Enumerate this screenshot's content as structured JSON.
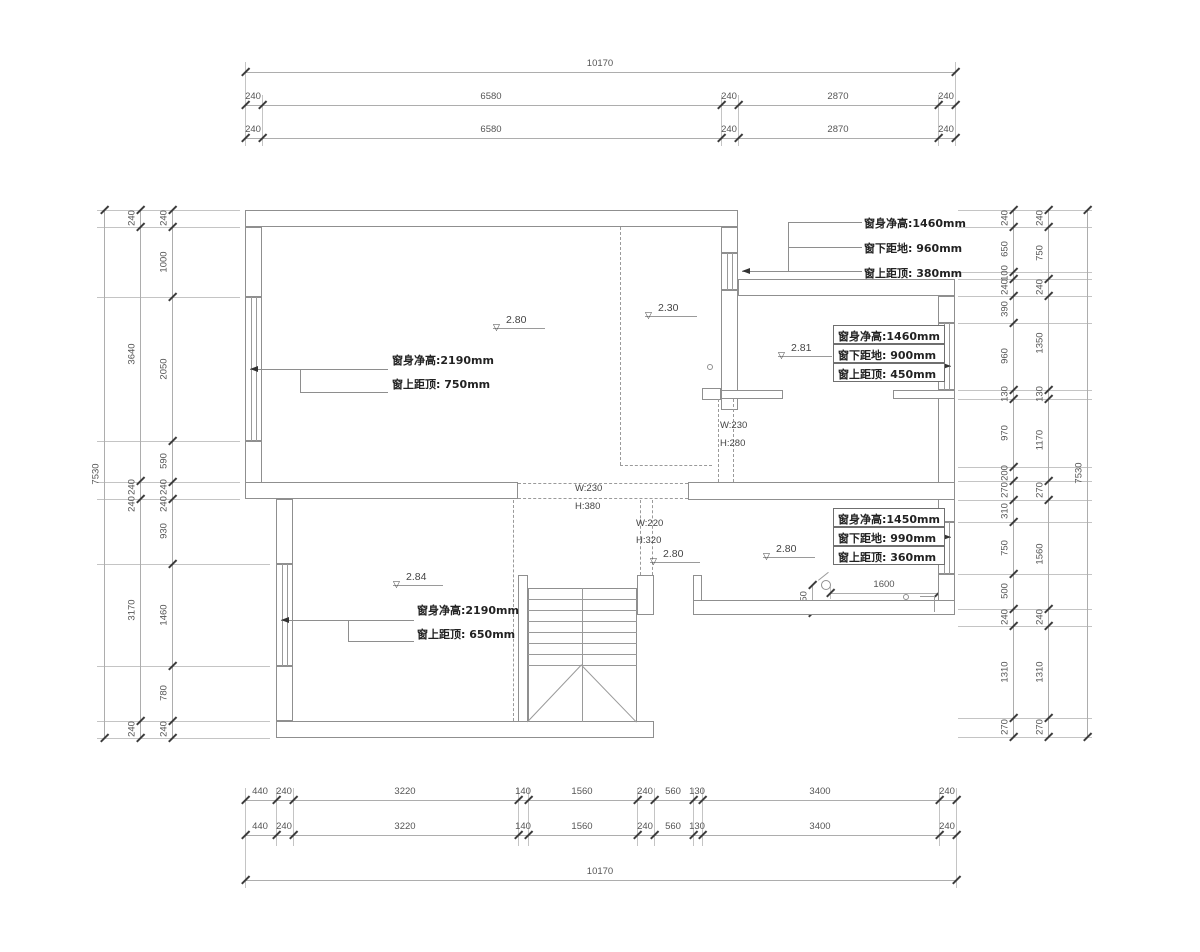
{
  "drawing_type": "floor-plan",
  "colors": {
    "wall": "#8f8f8f",
    "dim_text": "#555555",
    "tick": "#3c3c3c",
    "annotation": "#222222",
    "leader": "#8e8e8e"
  },
  "chains": [
    {
      "id": "top-total",
      "dir": "h",
      "pos": 72,
      "from": 245,
      "to": 955,
      "ticks": [
        245,
        955
      ],
      "labels": [
        {
          "t": "10170",
          "p": 600
        }
      ]
    },
    {
      "id": "top-row1",
      "dir": "h",
      "pos": 105,
      "from": 245,
      "to": 955,
      "ticks": [
        245,
        262,
        721,
        738,
        938,
        955
      ],
      "labels": [
        {
          "t": "240",
          "p": 253
        },
        {
          "t": "6580",
          "p": 491
        },
        {
          "t": "240",
          "p": 729
        },
        {
          "t": "2870",
          "p": 838
        },
        {
          "t": "240",
          "p": 946
        }
      ]
    },
    {
      "id": "top-row2",
      "dir": "h",
      "pos": 138,
      "from": 245,
      "to": 955,
      "ticks": [
        245,
        262,
        721,
        738,
        938,
        955
      ],
      "labels": [
        {
          "t": "240",
          "p": 253
        },
        {
          "t": "6580",
          "p": 491
        },
        {
          "t": "240",
          "p": 729
        },
        {
          "t": "2870",
          "p": 838
        },
        {
          "t": "240",
          "p": 946
        }
      ]
    },
    {
      "id": "bottom-row1",
      "dir": "h",
      "pos": 800,
      "from": 245,
      "to": 956,
      "ticks": [
        245,
        276,
        293,
        518,
        528,
        637,
        654,
        693,
        702,
        939,
        956
      ],
      "labels": [
        {
          "t": "440",
          "p": 260
        },
        {
          "t": "240",
          "p": 284
        },
        {
          "t": "3220",
          "p": 405
        },
        {
          "t": "140",
          "p": 523
        },
        {
          "t": "1560",
          "p": 582
        },
        {
          "t": "240",
          "p": 645
        },
        {
          "t": "560",
          "p": 673
        },
        {
          "t": "130",
          "p": 697
        },
        {
          "t": "3400",
          "p": 820
        },
        {
          "t": "240",
          "p": 947
        }
      ]
    },
    {
      "id": "bottom-row2",
      "dir": "h",
      "pos": 835,
      "from": 245,
      "to": 956,
      "ticks": [
        245,
        276,
        293,
        518,
        528,
        637,
        654,
        693,
        702,
        939,
        956
      ],
      "labels": [
        {
          "t": "440",
          "p": 260
        },
        {
          "t": "240",
          "p": 284
        },
        {
          "t": "3220",
          "p": 405
        },
        {
          "t": "140",
          "p": 523
        },
        {
          "t": "1560",
          "p": 582
        },
        {
          "t": "240",
          "p": 645
        },
        {
          "t": "560",
          "p": 673
        },
        {
          "t": "130",
          "p": 697
        },
        {
          "t": "3400",
          "p": 820
        },
        {
          "t": "240",
          "p": 947
        }
      ]
    },
    {
      "id": "bottom-total",
      "dir": "h",
      "pos": 880,
      "from": 245,
      "to": 956,
      "ticks": [
        245,
        956
      ],
      "labels": [
        {
          "t": "10170",
          "p": 600
        }
      ]
    },
    {
      "id": "left-outer",
      "dir": "v",
      "pos": 104,
      "from": 210,
      "to": 738,
      "ticks": [
        210,
        738
      ],
      "labels": [
        {
          "t": "7530",
          "p": 474
        }
      ]
    },
    {
      "id": "left-mid",
      "dir": "v",
      "pos": 140,
      "from": 210,
      "to": 738,
      "ticks": [
        210,
        227,
        481,
        499,
        721,
        738
      ],
      "labels": [
        {
          "t": "240",
          "p": 218
        },
        {
          "t": "3640",
          "p": 354
        },
        {
          "t": "240",
          "p": 487
        },
        {
          "t": "240",
          "p": 504
        },
        {
          "t": "3170",
          "p": 610
        },
        {
          "t": "240",
          "p": 729
        }
      ]
    },
    {
      "id": "left-inner",
      "dir": "v",
      "pos": 172,
      "from": 210,
      "to": 738,
      "ticks": [
        210,
        227,
        297,
        441,
        482,
        499,
        564,
        666,
        721,
        738
      ],
      "labels": [
        {
          "t": "240",
          "p": 218
        },
        {
          "t": "1000",
          "p": 262
        },
        {
          "t": "2050",
          "p": 369
        },
        {
          "t": "590",
          "p": 461
        },
        {
          "t": "240",
          "p": 487
        },
        {
          "t": "240",
          "p": 504
        },
        {
          "t": "930",
          "p": 531
        },
        {
          "t": "1460",
          "p": 615
        },
        {
          "t": "780",
          "p": 693
        },
        {
          "t": "240",
          "p": 729
        }
      ]
    },
    {
      "id": "right-inner",
      "dir": "v",
      "pos": 1013,
      "from": 210,
      "to": 737,
      "ticks": [
        210,
        227,
        272,
        279,
        296,
        323,
        390,
        399,
        467,
        481,
        500,
        522,
        574,
        609,
        626,
        718,
        737
      ],
      "labels": [
        {
          "t": "240",
          "p": 218
        },
        {
          "t": "650",
          "p": 249
        },
        {
          "t": "100",
          "p": 273
        },
        {
          "t": "240",
          "p": 287
        },
        {
          "t": "390",
          "p": 309
        },
        {
          "t": "960",
          "p": 356
        },
        {
          "t": "130",
          "p": 394
        },
        {
          "t": "970",
          "p": 433
        },
        {
          "t": "200",
          "p": 473
        },
        {
          "t": "270",
          "p": 490
        },
        {
          "t": "310",
          "p": 511
        },
        {
          "t": "750",
          "p": 548
        },
        {
          "t": "500",
          "p": 591
        },
        {
          "t": "240",
          "p": 617
        },
        {
          "t": "1310",
          "p": 672
        },
        {
          "t": "270",
          "p": 727
        }
      ]
    },
    {
      "id": "right-mid",
      "dir": "v",
      "pos": 1048,
      "from": 210,
      "to": 737,
      "ticks": [
        210,
        227,
        279,
        296,
        390,
        399,
        481,
        500,
        609,
        626,
        718,
        737
      ],
      "labels": [
        {
          "t": "240",
          "p": 218
        },
        {
          "t": "750",
          "p": 253
        },
        {
          "t": "240",
          "p": 287
        },
        {
          "t": "1350",
          "p": 343
        },
        {
          "t": "130",
          "p": 394
        },
        {
          "t": "1170",
          "p": 440
        },
        {
          "t": "270",
          "p": 490
        },
        {
          "t": "1560",
          "p": 554
        },
        {
          "t": "240",
          "p": 617
        },
        {
          "t": "1310",
          "p": 672
        },
        {
          "t": "270",
          "p": 727
        }
      ]
    },
    {
      "id": "right-outer",
      "dir": "v",
      "pos": 1087,
      "from": 210,
      "to": 737,
      "ticks": [
        210,
        737
      ],
      "labels": [
        {
          "t": "7530",
          "p": 473
        }
      ]
    },
    {
      "id": "dim-1600",
      "dir": "h",
      "pos": 593,
      "from": 830,
      "to": 938,
      "ticks": [
        830,
        938
      ],
      "labels": [
        {
          "t": "1600",
          "p": 884
        }
      ]
    },
    {
      "id": "dim-350",
      "dir": "v",
      "pos": 812,
      "from": 585,
      "to": 613,
      "ticks": [
        585,
        613
      ],
      "labels": [
        {
          "t": "350",
          "p": 599
        }
      ]
    }
  ],
  "ext_lines": [
    {
      "x1": 245,
      "y1": 62,
      "x2": 245,
      "y2": 146
    },
    {
      "x1": 955,
      "y1": 62,
      "x2": 955,
      "y2": 146
    },
    {
      "x1": 262,
      "y1": 95,
      "x2": 262,
      "y2": 146
    },
    {
      "x1": 721,
      "y1": 95,
      "x2": 721,
      "y2": 146
    },
    {
      "x1": 738,
      "y1": 95,
      "x2": 738,
      "y2": 146
    },
    {
      "x1": 938,
      "y1": 95,
      "x2": 938,
      "y2": 146
    },
    {
      "x1": 245,
      "y1": 788,
      "x2": 245,
      "y2": 888
    },
    {
      "x1": 956,
      "y1": 788,
      "x2": 956,
      "y2": 888
    },
    {
      "x1": 276,
      "y1": 788,
      "x2": 276,
      "y2": 846
    },
    {
      "x1": 293,
      "y1": 788,
      "x2": 293,
      "y2": 846
    },
    {
      "x1": 518,
      "y1": 788,
      "x2": 518,
      "y2": 846
    },
    {
      "x1": 528,
      "y1": 788,
      "x2": 528,
      "y2": 846
    },
    {
      "x1": 637,
      "y1": 788,
      "x2": 637,
      "y2": 846
    },
    {
      "x1": 654,
      "y1": 788,
      "x2": 654,
      "y2": 846
    },
    {
      "x1": 693,
      "y1": 788,
      "x2": 693,
      "y2": 846
    },
    {
      "x1": 702,
      "y1": 788,
      "x2": 702,
      "y2": 846
    },
    {
      "x1": 939,
      "y1": 788,
      "x2": 939,
      "y2": 846
    },
    {
      "x1": 97,
      "y1": 210,
      "x2": 240,
      "y2": 210
    },
    {
      "x1": 97,
      "y1": 227,
      "x2": 240,
      "y2": 227
    },
    {
      "x1": 97,
      "y1": 297,
      "x2": 240,
      "y2": 297
    },
    {
      "x1": 97,
      "y1": 441,
      "x2": 240,
      "y2": 441
    },
    {
      "x1": 97,
      "y1": 482,
      "x2": 240,
      "y2": 482
    },
    {
      "x1": 97,
      "y1": 499,
      "x2": 240,
      "y2": 499
    },
    {
      "x1": 97,
      "y1": 564,
      "x2": 270,
      "y2": 564
    },
    {
      "x1": 97,
      "y1": 666,
      "x2": 270,
      "y2": 666
    },
    {
      "x1": 97,
      "y1": 721,
      "x2": 270,
      "y2": 721
    },
    {
      "x1": 97,
      "y1": 738,
      "x2": 270,
      "y2": 738
    },
    {
      "x1": 958,
      "y1": 210,
      "x2": 1092,
      "y2": 210
    },
    {
      "x1": 958,
      "y1": 227,
      "x2": 1092,
      "y2": 227
    },
    {
      "x1": 958,
      "y1": 272,
      "x2": 1092,
      "y2": 272
    },
    {
      "x1": 958,
      "y1": 279,
      "x2": 1092,
      "y2": 279
    },
    {
      "x1": 958,
      "y1": 296,
      "x2": 1092,
      "y2": 296
    },
    {
      "x1": 958,
      "y1": 323,
      "x2": 1092,
      "y2": 323
    },
    {
      "x1": 958,
      "y1": 390,
      "x2": 1092,
      "y2": 390
    },
    {
      "x1": 958,
      "y1": 399,
      "x2": 1092,
      "y2": 399
    },
    {
      "x1": 958,
      "y1": 467,
      "x2": 1092,
      "y2": 467
    },
    {
      "x1": 958,
      "y1": 481,
      "x2": 1092,
      "y2": 481
    },
    {
      "x1": 958,
      "y1": 500,
      "x2": 1092,
      "y2": 500
    },
    {
      "x1": 958,
      "y1": 522,
      "x2": 1092,
      "y2": 522
    },
    {
      "x1": 958,
      "y1": 574,
      "x2": 1092,
      "y2": 574
    },
    {
      "x1": 958,
      "y1": 609,
      "x2": 1092,
      "y2": 609
    },
    {
      "x1": 958,
      "y1": 626,
      "x2": 1092,
      "y2": 626
    },
    {
      "x1": 958,
      "y1": 718,
      "x2": 1092,
      "y2": 718
    },
    {
      "x1": 958,
      "y1": 737,
      "x2": 1092,
      "y2": 737
    },
    {
      "x1": 830,
      "y1": 587,
      "x2": 830,
      "y2": 599
    },
    {
      "x1": 938,
      "y1": 587,
      "x2": 938,
      "y2": 599
    }
  ],
  "walls": [
    {
      "x": 245,
      "y": 210,
      "w": 493,
      "h": 17
    },
    {
      "x": 738,
      "y": 279,
      "w": 217,
      "h": 17
    },
    {
      "x": 245,
      "y": 227,
      "w": 17,
      "h": 70
    },
    {
      "x": 245,
      "y": 441,
      "w": 17,
      "h": 58
    },
    {
      "x": 276,
      "y": 499,
      "w": 17,
      "h": 65
    },
    {
      "x": 276,
      "y": 666,
      "w": 17,
      "h": 55
    },
    {
      "x": 276,
      "y": 721,
      "w": 378,
      "h": 17
    },
    {
      "x": 938,
      "y": 296,
      "w": 17,
      "h": 27
    },
    {
      "x": 938,
      "y": 390,
      "w": 17,
      "h": 132
    },
    {
      "x": 938,
      "y": 574,
      "w": 17,
      "h": 41
    },
    {
      "x": 721,
      "y": 227,
      "w": 17,
      "h": 26
    },
    {
      "x": 721,
      "y": 290,
      "w": 17,
      "h": 120
    },
    {
      "x": 245,
      "y": 482,
      "w": 273,
      "h": 17
    },
    {
      "x": 688,
      "y": 482,
      "w": 267,
      "h": 18
    },
    {
      "x": 721,
      "y": 390,
      "w": 62,
      "h": 9
    },
    {
      "x": 893,
      "y": 390,
      "w": 62,
      "h": 9
    },
    {
      "x": 702,
      "y": 388,
      "w": 19,
      "h": 12
    },
    {
      "x": 637,
      "y": 575,
      "w": 17,
      "h": 40
    },
    {
      "x": 693,
      "y": 575,
      "w": 9,
      "h": 40
    },
    {
      "x": 693,
      "y": 600,
      "w": 262,
      "h": 15
    },
    {
      "x": 518,
      "y": 575,
      "w": 10,
      "h": 147
    },
    {
      "x": 528,
      "y": 588,
      "w": 109,
      "h": 134
    }
  ],
  "windows": [
    {
      "x": 245,
      "y": 297,
      "w": 17,
      "h": 144
    },
    {
      "x": 276,
      "y": 564,
      "w": 17,
      "h": 102
    },
    {
      "x": 721,
      "y": 253,
      "w": 17,
      "h": 37
    },
    {
      "x": 938,
      "y": 323,
      "w": 17,
      "h": 67
    },
    {
      "x": 938,
      "y": 522,
      "w": 17,
      "h": 52
    }
  ],
  "dashed": [
    {
      "x1": 620,
      "y1": 227,
      "x2": 620,
      "y2": 465
    },
    {
      "x1": 620,
      "y1": 465,
      "x2": 712,
      "y2": 465
    },
    {
      "x1": 718,
      "y1": 399,
      "x2": 718,
      "y2": 482
    },
    {
      "x1": 733,
      "y1": 399,
      "x2": 733,
      "y2": 482
    },
    {
      "x1": 518,
      "y1": 483,
      "x2": 688,
      "y2": 483
    },
    {
      "x1": 518,
      "y1": 498,
      "x2": 688,
      "y2": 498
    },
    {
      "x1": 513,
      "y1": 500,
      "x2": 513,
      "y2": 721
    },
    {
      "x1": 640,
      "y1": 500,
      "x2": 640,
      "y2": 575
    },
    {
      "x1": 652,
      "y1": 500,
      "x2": 652,
      "y2": 575
    }
  ],
  "plan_lines": [
    {
      "x1": 528,
      "y1": 599,
      "x2": 637,
      "y2": 599
    },
    {
      "x1": 528,
      "y1": 610,
      "x2": 637,
      "y2": 610
    },
    {
      "x1": 528,
      "y1": 621,
      "x2": 637,
      "y2": 621
    },
    {
      "x1": 528,
      "y1": 632,
      "x2": 637,
      "y2": 632
    },
    {
      "x1": 528,
      "y1": 643,
      "x2": 637,
      "y2": 643
    },
    {
      "x1": 528,
      "y1": 654,
      "x2": 637,
      "y2": 654
    },
    {
      "x1": 528,
      "y1": 665,
      "x2": 637,
      "y2": 665
    },
    {
      "x1": 582,
      "y1": 588,
      "x2": 582,
      "y2": 722
    },
    {
      "x1": 582,
      "y1": 665,
      "x2": 528,
      "y2": 722
    },
    {
      "x1": 582,
      "y1": 665,
      "x2": 637,
      "y2": 722
    },
    {
      "x1": 920,
      "y1": 596,
      "x2": 934,
      "y2": 596
    },
    {
      "x1": 934,
      "y1": 596,
      "x2": 934,
      "y2": 612
    },
    {
      "x1": 818,
      "y1": 580,
      "x2": 828,
      "y2": 572
    }
  ],
  "leaders": [
    {
      "x1": 788,
      "y1": 222,
      "x2": 862,
      "y2": 222
    },
    {
      "x1": 788,
      "y1": 247,
      "x2": 862,
      "y2": 247
    },
    {
      "x1": 742,
      "y1": 271,
      "x2": 862,
      "y2": 271
    },
    {
      "x1": 788,
      "y1": 222,
      "x2": 788,
      "y2": 271
    },
    {
      "x1": 250,
      "y1": 369,
      "x2": 388,
      "y2": 369
    },
    {
      "x1": 300,
      "y1": 369,
      "x2": 300,
      "y2": 392
    },
    {
      "x1": 300,
      "y1": 392,
      "x2": 388,
      "y2": 392
    },
    {
      "x1": 281,
      "y1": 620,
      "x2": 414,
      "y2": 620
    },
    {
      "x1": 348,
      "y1": 620,
      "x2": 348,
      "y2": 641
    },
    {
      "x1": 348,
      "y1": 641,
      "x2": 414,
      "y2": 641
    },
    {
      "x1": 945,
      "y1": 366,
      "x2": 951,
      "y2": 366
    },
    {
      "x1": 945,
      "y1": 537,
      "x2": 951,
      "y2": 537
    }
  ],
  "arrows": [
    {
      "x": 250,
      "y": 369,
      "dir": "left"
    },
    {
      "x": 281,
      "y": 620,
      "dir": "left"
    },
    {
      "x": 742,
      "y": 271,
      "dir": "left"
    },
    {
      "x": 951,
      "y": 366,
      "dir": "right"
    },
    {
      "x": 951,
      "y": 537,
      "dir": "right"
    }
  ],
  "annotations": [
    {
      "x": 864,
      "y": 215,
      "t": "窗身净高:1460mm",
      "cls": "cn"
    },
    {
      "x": 864,
      "y": 240,
      "t": "窗下距地: 960mm",
      "cls": "cn"
    },
    {
      "x": 864,
      "y": 265,
      "t": "窗上距顶: 380mm",
      "cls": "cn"
    },
    {
      "x": 392,
      "y": 352,
      "t": "窗身净高:2190mm",
      "cls": "cn"
    },
    {
      "x": 392,
      "y": 376,
      "t": "窗上距顶: 750mm",
      "cls": "cn"
    },
    {
      "x": 417,
      "y": 602,
      "t": "窗身净高:2190mm",
      "cls": "cn"
    },
    {
      "x": 417,
      "y": 626,
      "t": "窗上距顶: 650mm",
      "cls": "cn"
    },
    {
      "x": 575,
      "y": 483,
      "t": "W:230",
      "cls": "duct"
    },
    {
      "x": 575,
      "y": 501,
      "t": "H:380",
      "cls": "duct"
    },
    {
      "x": 636,
      "y": 518,
      "t": "W:220",
      "cls": "duct"
    },
    {
      "x": 636,
      "y": 535,
      "t": "H:320",
      "cls": "duct"
    },
    {
      "x": 720,
      "y": 420,
      "t": "W:230",
      "cls": "duct"
    },
    {
      "x": 720,
      "y": 438,
      "t": "H:280",
      "cls": "duct"
    }
  ],
  "boxes": [
    {
      "x": 833,
      "y": 325,
      "w": 112,
      "rh": 19,
      "rows": [
        "窗身净高:1460mm",
        "窗下距地: 900mm",
        "窗上距顶: 450mm"
      ]
    },
    {
      "x": 833,
      "y": 508,
      "w": 112,
      "rh": 19,
      "rows": [
        "窗身净高:1450mm",
        "窗下距地: 990mm",
        "窗上距顶: 360mm"
      ]
    }
  ],
  "levels": [
    {
      "v": "2.80",
      "x": 493,
      "y": 328,
      "len": 52
    },
    {
      "v": "2.30",
      "x": 645,
      "y": 316,
      "len": 52
    },
    {
      "v": "2.81",
      "x": 778,
      "y": 356,
      "len": 54
    },
    {
      "v": "2.84",
      "x": 393,
      "y": 585,
      "len": 50
    },
    {
      "v": "2.80",
      "x": 650,
      "y": 562,
      "len": 50
    },
    {
      "v": "2.80",
      "x": 763,
      "y": 557,
      "len": 52
    }
  ],
  "circles": [
    {
      "x": 710,
      "y": 367,
      "r": 3
    },
    {
      "x": 826,
      "y": 585,
      "r": 5
    },
    {
      "x": 906,
      "y": 597,
      "r": 3
    }
  ]
}
